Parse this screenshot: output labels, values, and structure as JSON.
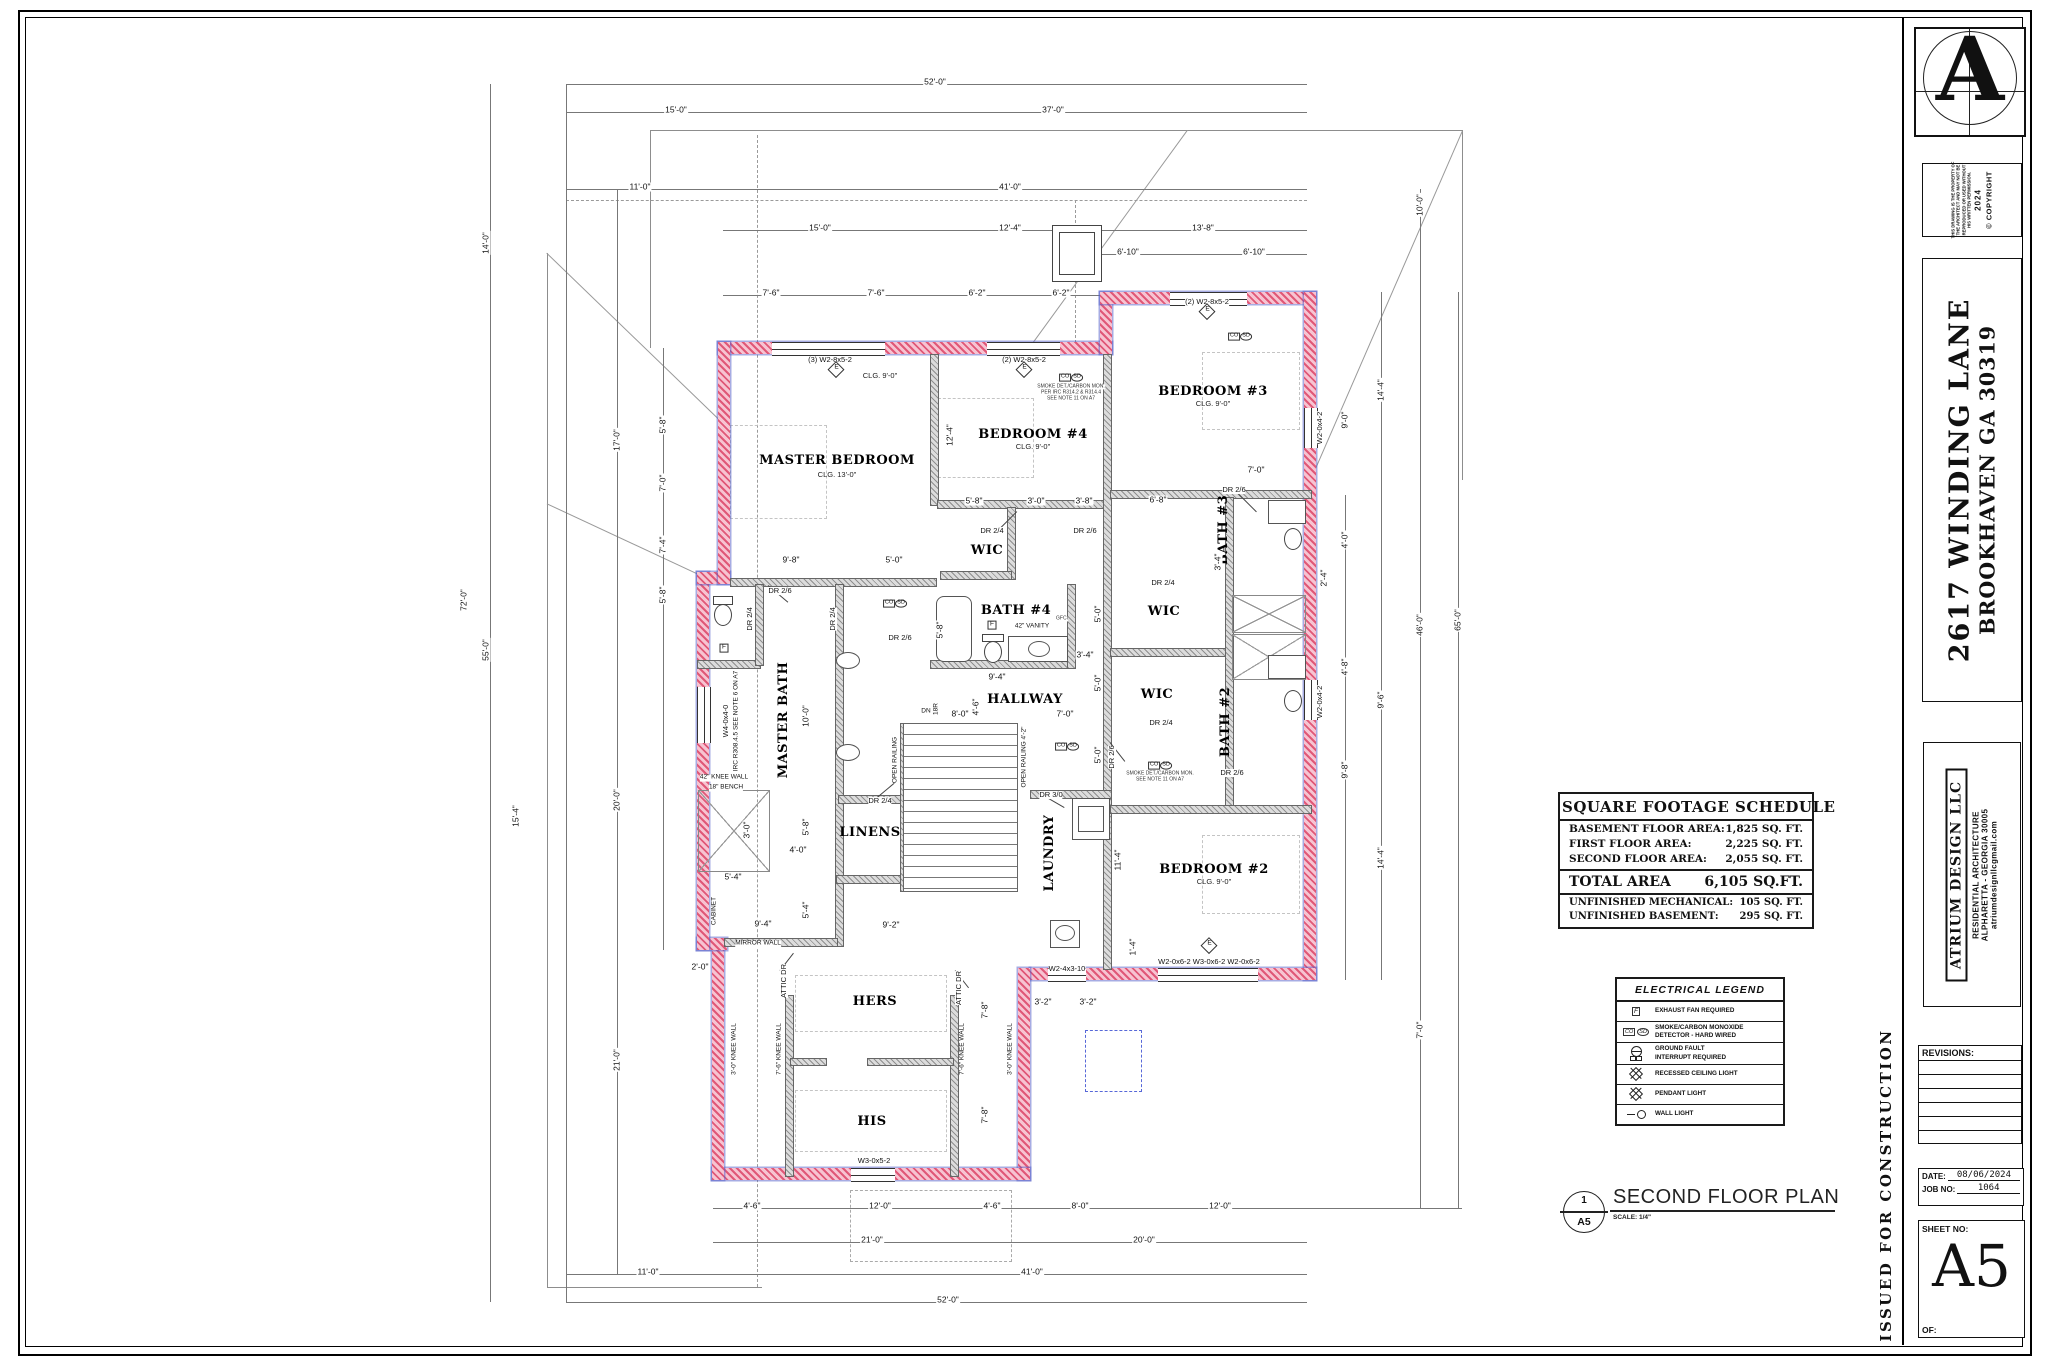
{
  "sheet": {
    "logo_letter": "A",
    "copyright_note": "THIS DRAWING IS THE PROPERTY OF THE ARCHITECT AND MAY NOT BE REPRODUCED OR USED WITHOUT HIS WRITTEN PERMISSION.",
    "copyright_year": "2024",
    "copyright_mark": "© COPYRIGHT",
    "address_line1": "2617 WINDING LANE",
    "address_line2": "BROOKHAVEN GA 30319",
    "firm_name": "ATRIUM DESIGN LLC",
    "firm_line1": "RESIDENTIAL ARCHITECTURE",
    "firm_line2": "ALPHARETTA -  GEORGIA 30005",
    "firm_line3": "atriumdesignllcgmail.com",
    "revisions_label": "REVISIONS:",
    "date_label": "DATE:",
    "date_value": "08/06/2024",
    "job_label": "JOB NO:",
    "job_value": "1064",
    "sheet_no_label": "SHEET NO:",
    "sheet_no": "A5",
    "of_label": "OF:",
    "issued": "ISSUED FOR CONSTRUCTION"
  },
  "schedule": {
    "title": "SQUARE FOOTAGE SCHEDULE",
    "rows": [
      {
        "label": "BASEMENT FLOOR AREA:",
        "value": "1,825 SQ. FT."
      },
      {
        "label": "FIRST FLOOR AREA:",
        "value": "2,225 SQ. FT."
      },
      {
        "label": "SECOND FLOOR AREA:",
        "value": "2,055 SQ. FT."
      }
    ],
    "total_label": "TOTAL AREA",
    "total_value": "6,105 SQ.FT.",
    "extra_rows": [
      {
        "label": "UNFINISHED MECHANICAL:",
        "value": "105 SQ. FT."
      },
      {
        "label": "UNFINISHED BASEMENT:",
        "value": "295 SQ. FT."
      }
    ]
  },
  "legend": {
    "title": "ELECTRICAL LEGEND",
    "rows": [
      {
        "symbol": "exhaust-fan",
        "text": "EXHAUST FAN REQUIRED"
      },
      {
        "symbol": "smoke-co-detector",
        "text": "SMOKE/CARBON MONOXIDE\nDETECTOR - HARD WIRED"
      },
      {
        "symbol": "ground-fault",
        "text": "GROUND FAULT\nINTERRUPT REQUIRED"
      },
      {
        "symbol": "recessed-light",
        "text": "RECESSED CEILING LIGHT"
      },
      {
        "symbol": "pendant-light",
        "text": "PENDANT LIGHT"
      },
      {
        "symbol": "wall-light",
        "text": "WALL LIGHT"
      }
    ]
  },
  "plan_title": {
    "detail_number": "1",
    "detail_sheet": "A5",
    "title": "SECOND FLOOR PLAN",
    "scale": "SCALE: 1/4\""
  },
  "colors": {
    "exterior_wall": "#e05878",
    "insulation": "#5768d8",
    "interior_wall": "#8f8f8f"
  },
  "plan": {
    "annotations": [
      {
        "k": "room",
        "t": "MASTER BEDROOM",
        "x": 837,
        "y": 461
      },
      {
        "k": "sub",
        "t": "CLG. 13'-0\"",
        "x": 837,
        "y": 475
      },
      {
        "k": "room",
        "t": "BEDROOM #4",
        "x": 1033,
        "y": 435
      },
      {
        "k": "sub",
        "t": "CLG. 9'-0\"",
        "x": 1033,
        "y": 447
      },
      {
        "k": "room",
        "t": "BEDROOM #3",
        "x": 1213,
        "y": 392
      },
      {
        "k": "sub",
        "t": "CLG. 9'-0\"",
        "x": 1213,
        "y": 404
      },
      {
        "k": "room",
        "t": "BEDROOM #2",
        "x": 1214,
        "y": 870
      },
      {
        "k": "sub",
        "t": "CLG. 9'-0\"",
        "x": 1214,
        "y": 882
      },
      {
        "k": "sub",
        "t": "CLG. 9'-0\"",
        "x": 880,
        "y": 376
      },
      {
        "k": "room",
        "t": "MASTER BATH",
        "x": 784,
        "y": 720,
        "r": 1
      },
      {
        "k": "room",
        "t": "BATH #4",
        "x": 1016,
        "y": 611
      },
      {
        "k": "room",
        "t": "BATH #3",
        "x": 1224,
        "y": 530,
        "r": 1
      },
      {
        "k": "room",
        "t": "BATH #2",
        "x": 1226,
        "y": 722,
        "r": 1
      },
      {
        "k": "room",
        "t": "HALLWAY",
        "x": 1025,
        "y": 700
      },
      {
        "k": "room",
        "t": "LINENS",
        "x": 870,
        "y": 833
      },
      {
        "k": "room",
        "t": "LAUNDRY",
        "x": 1050,
        "y": 853,
        "r": 1
      },
      {
        "k": "room",
        "t": "HERS",
        "x": 875,
        "y": 1002
      },
      {
        "k": "room",
        "t": "HIS",
        "x": 872,
        "y": 1122
      },
      {
        "k": "room",
        "t": "WIC",
        "x": 987,
        "y": 551
      },
      {
        "k": "room",
        "t": "WIC",
        "x": 1164,
        "y": 612
      },
      {
        "k": "room",
        "t": "WIC",
        "x": 1157,
        "y": 695
      },
      {
        "k": "dim",
        "t": "52'-0\"",
        "x": 935,
        "y": 82
      },
      {
        "k": "dim",
        "t": "15'-0\"",
        "x": 676,
        "y": 110
      },
      {
        "k": "dim",
        "t": "37'-0\"",
        "x": 1053,
        "y": 110
      },
      {
        "k": "dim",
        "t": "11'-0\"",
        "x": 640,
        "y": 187
      },
      {
        "k": "dim",
        "t": "41'-0\"",
        "x": 1010,
        "y": 187
      },
      {
        "k": "dim",
        "t": "15'-0\"",
        "x": 820,
        "y": 228
      },
      {
        "k": "dim",
        "t": "12'-4\"",
        "x": 1010,
        "y": 228
      },
      {
        "k": "dim",
        "t": "13'-8\"",
        "x": 1203,
        "y": 228
      },
      {
        "k": "dim",
        "t": "6'-10\"",
        "x": 1128,
        "y": 252
      },
      {
        "k": "dim",
        "t": "6'-10\"",
        "x": 1254,
        "y": 252
      },
      {
        "k": "dim",
        "t": "7'-6\"",
        "x": 771,
        "y": 293
      },
      {
        "k": "dim",
        "t": "7'-6\"",
        "x": 876,
        "y": 293
      },
      {
        "k": "dim",
        "t": "6'-2\"",
        "x": 977,
        "y": 293
      },
      {
        "k": "dim",
        "t": "6'-2\"",
        "x": 1061,
        "y": 293
      },
      {
        "k": "dim",
        "t": "4'-6\"",
        "x": 752,
        "y": 1206
      },
      {
        "k": "dim",
        "t": "12'-0\"",
        "x": 880,
        "y": 1206
      },
      {
        "k": "dim",
        "t": "4'-6\"",
        "x": 992,
        "y": 1206
      },
      {
        "k": "dim",
        "t": "8'-0\"",
        "x": 1080,
        "y": 1206
      },
      {
        "k": "dim",
        "t": "12'-0\"",
        "x": 1220,
        "y": 1206
      },
      {
        "k": "dim",
        "t": "21'-0\"",
        "x": 872,
        "y": 1240
      },
      {
        "k": "dim",
        "t": "20'-0\"",
        "x": 1144,
        "y": 1240
      },
      {
        "k": "dim",
        "t": "11'-0\"",
        "x": 648,
        "y": 1272
      },
      {
        "k": "dim",
        "t": "41'-0\"",
        "x": 1032,
        "y": 1272
      },
      {
        "k": "dim",
        "t": "52'-0\"",
        "x": 948,
        "y": 1300
      },
      {
        "k": "dim",
        "t": "72'-0\"",
        "x": 464,
        "y": 600,
        "r": 1
      },
      {
        "k": "dim",
        "t": "14'-0\"",
        "x": 486,
        "y": 243,
        "r": 1
      },
      {
        "k": "dim",
        "t": "55'-0\"",
        "x": 486,
        "y": 650,
        "r": 1
      },
      {
        "k": "dim",
        "t": "17'-0\"",
        "x": 617,
        "y": 440,
        "r": 1
      },
      {
        "k": "dim",
        "t": "20'-0\"",
        "x": 617,
        "y": 800,
        "r": 1
      },
      {
        "k": "dim",
        "t": "21'-0\"",
        "x": 617,
        "y": 1060,
        "r": 1
      },
      {
        "k": "dim",
        "t": "5'-8\"",
        "x": 663,
        "y": 425,
        "r": 1
      },
      {
        "k": "dim",
        "t": "7'-0\"",
        "x": 663,
        "y": 483,
        "r": 1
      },
      {
        "k": "dim",
        "t": "7'-4\"",
        "x": 663,
        "y": 545,
        "r": 1
      },
      {
        "k": "dim",
        "t": "5'-8\"",
        "x": 663,
        "y": 595,
        "r": 1
      },
      {
        "k": "dim",
        "t": "15'-4\"",
        "x": 516,
        "y": 816,
        "r": 1
      },
      {
        "k": "dim",
        "t": "10'-0\"",
        "x": 1420,
        "y": 205,
        "r": 1
      },
      {
        "k": "dim",
        "t": "14'-4\"",
        "x": 1381,
        "y": 390,
        "r": 1
      },
      {
        "k": "dim",
        "t": "9'-0\"",
        "x": 1345,
        "y": 420,
        "r": 1
      },
      {
        "k": "dim",
        "t": "46'-0\"",
        "x": 1420,
        "y": 625,
        "r": 1
      },
      {
        "k": "dim",
        "t": "65'-0\"",
        "x": 1458,
        "y": 620,
        "r": 1
      },
      {
        "k": "dim",
        "t": "4'-0\"",
        "x": 1345,
        "y": 540,
        "r": 1
      },
      {
        "k": "dim",
        "t": "4'-8\"",
        "x": 1345,
        "y": 667,
        "r": 1
      },
      {
        "k": "dim",
        "t": "9'-6\"",
        "x": 1381,
        "y": 700,
        "r": 1
      },
      {
        "k": "dim",
        "t": "9'-8\"",
        "x": 1345,
        "y": 770,
        "r": 1
      },
      {
        "k": "dim",
        "t": "14'-4\"",
        "x": 1381,
        "y": 858,
        "r": 1
      },
      {
        "k": "dim",
        "t": "7'-0\"",
        "x": 1420,
        "y": 1030,
        "r": 1
      },
      {
        "k": "dim",
        "t": "9'-8\"",
        "x": 791,
        "y": 560
      },
      {
        "k": "dim",
        "t": "5'-0\"",
        "x": 894,
        "y": 560
      },
      {
        "k": "dim",
        "t": "5'-8\"",
        "x": 974,
        "y": 501
      },
      {
        "k": "dim",
        "t": "3'-0\"",
        "x": 1036,
        "y": 501
      },
      {
        "k": "dim",
        "t": "3'-8\"",
        "x": 1084,
        "y": 501
      },
      {
        "k": "dim",
        "t": "12'-4\"",
        "x": 950,
        "y": 435,
        "r": 1
      },
      {
        "k": "dim",
        "t": "7'-0\"",
        "x": 1256,
        "y": 470
      },
      {
        "k": "dim",
        "t": "6'-8\"",
        "x": 1158,
        "y": 500
      },
      {
        "k": "dim",
        "t": "9'-4\"",
        "x": 997,
        "y": 677
      },
      {
        "k": "dim",
        "t": "8'-0\"",
        "x": 960,
        "y": 714
      },
      {
        "k": "dim",
        "t": "7'-0\"",
        "x": 1065,
        "y": 714
      },
      {
        "k": "dim",
        "t": "4'-6\"",
        "x": 976,
        "y": 707,
        "r": 1
      },
      {
        "k": "dim",
        "t": "3'-4\"",
        "x": 1085,
        "y": 655
      },
      {
        "k": "dim",
        "t": "5'-0\"",
        "x": 1098,
        "y": 614,
        "r": 1
      },
      {
        "k": "dim",
        "t": "5'-0\"",
        "x": 1098,
        "y": 683,
        "r": 1
      },
      {
        "k": "dim",
        "t": "5'-0\"",
        "x": 1098,
        "y": 755,
        "r": 1
      },
      {
        "k": "dim",
        "t": "10'-0\"",
        "x": 806,
        "y": 716,
        "r": 1
      },
      {
        "k": "dim",
        "t": "5'-8\"",
        "x": 806,
        "y": 827,
        "r": 1
      },
      {
        "k": "dim",
        "t": "4'-0\"",
        "x": 798,
        "y": 850
      },
      {
        "k": "dim",
        "t": "5'-4\"",
        "x": 806,
        "y": 910,
        "r": 1
      },
      {
        "k": "dim",
        "t": "9'-4\"",
        "x": 763,
        "y": 924
      },
      {
        "k": "dim",
        "t": "9'-2\"",
        "x": 891,
        "y": 925
      },
      {
        "k": "dim",
        "t": "11'-4\"",
        "x": 1118,
        "y": 860,
        "r": 1
      },
      {
        "k": "dim",
        "t": "1'-4\"",
        "x": 1133,
        "y": 947,
        "r": 1
      },
      {
        "k": "dim",
        "t": "3'-2\"",
        "x": 1043,
        "y": 1002
      },
      {
        "k": "dim",
        "t": "3'-2\"",
        "x": 1088,
        "y": 1002
      },
      {
        "k": "dim",
        "t": "7'-8\"",
        "x": 985,
        "y": 1010,
        "r": 1
      },
      {
        "k": "dim",
        "t": "7'-8\"",
        "x": 985,
        "y": 1115,
        "r": 1
      },
      {
        "k": "dim",
        "t": "3'-4\"",
        "x": 1218,
        "y": 562,
        "r": 1
      },
      {
        "k": "dim",
        "t": "2'-4\"",
        "x": 1324,
        "y": 578,
        "r": 1
      },
      {
        "k": "dim",
        "t": "5'-8\"",
        "x": 940,
        "y": 630,
        "r": 1
      },
      {
        "k": "dim",
        "t": "3'-0\"",
        "x": 747,
        "y": 830,
        "r": 1
      },
      {
        "k": "dim",
        "t": "5'-4\"",
        "x": 733,
        "y": 877
      },
      {
        "k": "dim",
        "t": "2'-0\"",
        "x": 700,
        "y": 967
      },
      {
        "k": "win",
        "t": "(3) W2-8x5-2",
        "x": 830,
        "y": 360
      },
      {
        "k": "win",
        "t": "(2) W2-8x5-2",
        "x": 1024,
        "y": 360
      },
      {
        "k": "win",
        "t": "(2) W2-8x5-2",
        "x": 1207,
        "y": 302
      },
      {
        "k": "win",
        "t": "W2-0x6-2  W3-0x6-2  W2-0x6-2",
        "x": 1209,
        "y": 962
      },
      {
        "k": "win",
        "t": "W2-4x3-10",
        "x": 1067,
        "y": 969
      },
      {
        "k": "win",
        "t": "W3-0x5-2",
        "x": 874,
        "y": 1161
      },
      {
        "k": "win",
        "t": "W2-0x4-2",
        "x": 1320,
        "y": 702,
        "r": 1
      },
      {
        "k": "win",
        "t": "W2-0x4-2",
        "x": 1320,
        "y": 428,
        "r": 1
      },
      {
        "k": "win",
        "t": "W4-0x4-0",
        "x": 726,
        "y": 721,
        "r": 1
      },
      {
        "k": "note",
        "t": "IRC R308.4.5  SEE NOTE 6 ON A7",
        "x": 737,
        "y": 721,
        "r": 1
      },
      {
        "k": "door",
        "t": "DR 2/6",
        "x": 780,
        "y": 591
      },
      {
        "k": "door",
        "t": "DR 2/4",
        "x": 992,
        "y": 531
      },
      {
        "k": "door",
        "t": "DR 2/6",
        "x": 1085,
        "y": 531
      },
      {
        "k": "door",
        "t": "DR 2/6",
        "x": 1234,
        "y": 490
      },
      {
        "k": "door",
        "t": "DR 2/4",
        "x": 1163,
        "y": 583
      },
      {
        "k": "door",
        "t": "DR 2/4",
        "x": 1161,
        "y": 723
      },
      {
        "k": "door",
        "t": "DR 2/6",
        "x": 1112,
        "y": 757,
        "r": 1
      },
      {
        "k": "door",
        "t": "DR 3/0",
        "x": 1051,
        "y": 795
      },
      {
        "k": "door",
        "t": "DR 2/4",
        "x": 880,
        "y": 801
      },
      {
        "k": "door",
        "t": "DR 2/4",
        "x": 750,
        "y": 619,
        "r": 1
      },
      {
        "k": "door",
        "t": "DR 2/4",
        "x": 833,
        "y": 619,
        "r": 1
      },
      {
        "k": "door",
        "t": "DR 2/6",
        "x": 900,
        "y": 638
      },
      {
        "k": "door",
        "t": "DR 2/6",
        "x": 1232,
        "y": 773
      },
      {
        "k": "door",
        "t": "ATTIC DR",
        "x": 784,
        "y": 981,
        "r": 1
      },
      {
        "k": "door",
        "t": "ATTIC DR",
        "x": 959,
        "y": 988,
        "r": 1
      },
      {
        "k": "note",
        "t": "42\" VANITY",
        "x": 1032,
        "y": 627
      },
      {
        "k": "tiny",
        "t": "GFCI",
        "x": 1062,
        "y": 619
      },
      {
        "k": "note",
        "t": "42\" KNEE WALL",
        "x": 724,
        "y": 778
      },
      {
        "k": "note",
        "t": "18\" BENCH",
        "x": 726,
        "y": 788
      },
      {
        "k": "note",
        "t": "MIRROR WALL",
        "x": 758,
        "y": 944
      },
      {
        "k": "note",
        "t": "CABINET",
        "x": 715,
        "y": 911,
        "r": 1
      },
      {
        "k": "note",
        "t": "OPEN RAILING 4'-2\"",
        "x": 1025,
        "y": 757,
        "r": 1
      },
      {
        "k": "note",
        "t": "OPEN RAILING",
        "x": 896,
        "y": 760,
        "r": 1
      },
      {
        "k": "note",
        "t": "DN",
        "x": 926,
        "y": 712
      },
      {
        "k": "note",
        "t": "18R",
        "x": 937,
        "y": 709,
        "r": 1
      },
      {
        "k": "note",
        "t": "3'-0\" KNEE WALL",
        "x": 735,
        "y": 1049,
        "r": 1
      },
      {
        "k": "note",
        "t": "7'-6\" KNEE WALL",
        "x": 780,
        "y": 1049,
        "r": 1
      },
      {
        "k": "note",
        "t": "7'-6\" KNEE WALL",
        "x": 963,
        "y": 1049,
        "r": 1
      },
      {
        "k": "note",
        "t": "3'-0\" KNEE WALL",
        "x": 1011,
        "y": 1049,
        "r": 1
      },
      {
        "k": "tiny",
        "t": "SMOKE DET./CARBON MON.",
        "x": 1071,
        "y": 387
      },
      {
        "k": "tiny",
        "t": "PER IRC R314.2 & R314.4",
        "x": 1071,
        "y": 393
      },
      {
        "k": "tiny",
        "t": "SEE NOTE 11 ON A7",
        "x": 1071,
        "y": 399
      },
      {
        "k": "tiny",
        "t": "SMOKE DET./CARBON MON.",
        "x": 1160,
        "y": 774
      },
      {
        "k": "tiny",
        "t": "SEE NOTE 11 ON A7",
        "x": 1160,
        "y": 780
      },
      {
        "k": "cosd",
        "t": "CO SD",
        "x": 1071,
        "y": 374
      },
      {
        "k": "cosd",
        "t": "CO SD",
        "x": 1240,
        "y": 333
      },
      {
        "k": "cosd",
        "t": "CO SD",
        "x": 895,
        "y": 600
      },
      {
        "k": "cosd",
        "t": "CO SD",
        "x": 1067,
        "y": 743
      },
      {
        "k": "cosd",
        "t": "CO SD",
        "x": 1160,
        "y": 762
      },
      {
        "k": "e",
        "t": "E",
        "x": 836,
        "y": 372
      },
      {
        "k": "e",
        "t": "E",
        "x": 1024,
        "y": 372
      },
      {
        "k": "e",
        "t": "E",
        "x": 1207,
        "y": 314
      },
      {
        "k": "e",
        "t": "E",
        "x": 1209,
        "y": 948
      },
      {
        "k": "f",
        "t": "F",
        "x": 992,
        "y": 622
      },
      {
        "k": "f",
        "t": "F",
        "x": 724,
        "y": 645
      }
    ]
  }
}
